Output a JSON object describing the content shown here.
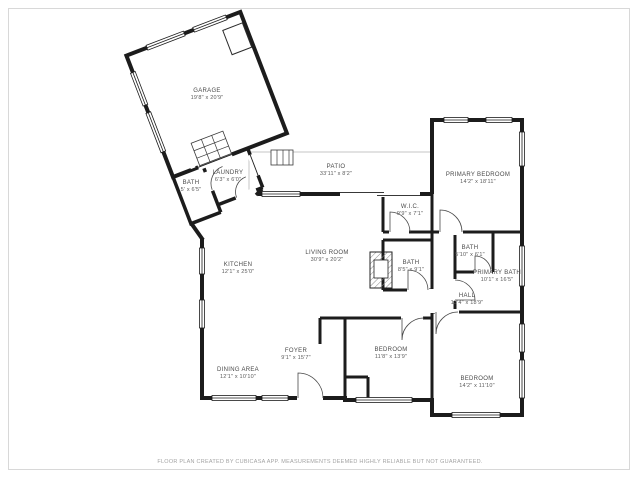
{
  "footer": {
    "disclaimer": "FLOOR PLAN CREATED BY CUBICASA APP. MEASUREMENTS DEEMED HIGHLY RELIABLE BUT NOT GUARANTEED."
  },
  "colors": {
    "wall": "#1c1c1c",
    "label_text": "#4a4a4a",
    "footer_text": "#a3a3a3",
    "frame_border": "#d8d8d8"
  },
  "rooms": {
    "garage": {
      "name": "GARAGE",
      "dims": "19'8\" x 20'9\""
    },
    "laundry": {
      "name": "LAUNDRY",
      "dims": "6'3\" x 6'0\""
    },
    "bath_laundry": {
      "name": "BATH",
      "dims": "5' x 6'5\""
    },
    "patio": {
      "name": "PATIO",
      "dims": "33'11\" x 8'2\""
    },
    "primary_bedroom": {
      "name": "PRIMARY BEDROOM",
      "dims": "14'2\" x 18'11\""
    },
    "wic": {
      "name": "W.I.C.",
      "dims": "9'9\" x 7'1\""
    },
    "bath_middle": {
      "name": "BATH",
      "dims": "8'5\" x 9'1\""
    },
    "hall": {
      "name": "HALL",
      "dims": "13'4\" x 18'9\""
    },
    "bath_right": {
      "name": "BATH",
      "dims": "5'10\" x 6'1\""
    },
    "primary_bath": {
      "name": "PRIMARY BATH",
      "dims": "10'1\" x 16'5\""
    },
    "living_room": {
      "name": "LIVING ROOM",
      "dims": "30'9\" x 20'2\""
    },
    "kitchen": {
      "name": "KITCHEN",
      "dims": "12'1\" x 25'0\""
    },
    "foyer": {
      "name": "FOYER",
      "dims": "9'1\" x 15'7\""
    },
    "dining_area": {
      "name": "DINING AREA",
      "dims": "12'1\" x 10'10\""
    },
    "bedroom_middle": {
      "name": "BEDROOM",
      "dims": "11'8\" x 13'9\""
    },
    "bedroom_right": {
      "name": "BEDROOM",
      "dims": "14'2\" x 11'10\""
    }
  }
}
